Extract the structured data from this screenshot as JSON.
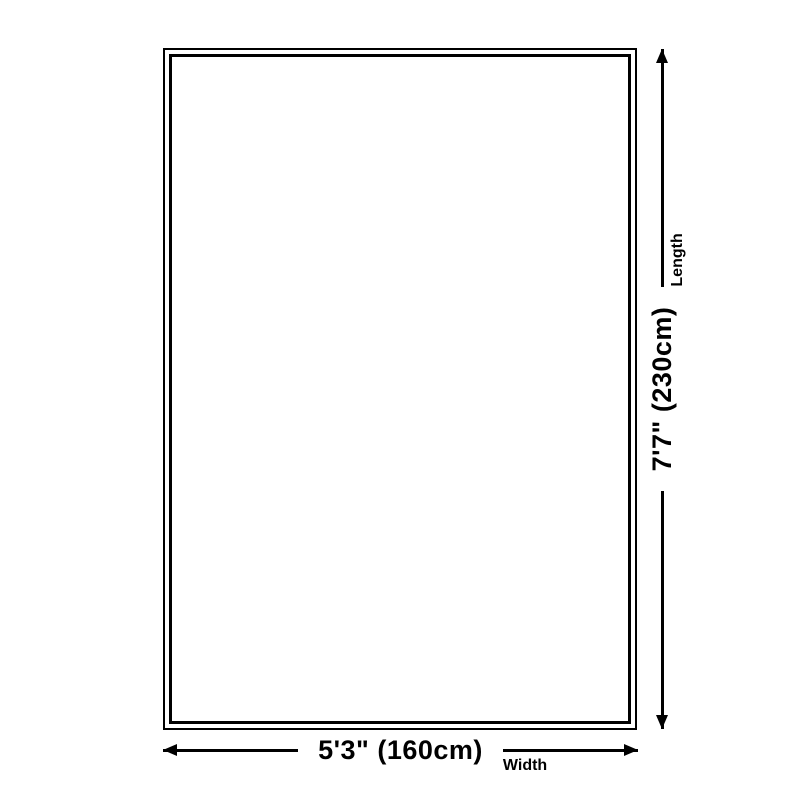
{
  "diagram": {
    "background_color": "#ffffff",
    "line_color": "#000000",
    "dimensions": {
      "width": {
        "value": "5'3\" (160cm)",
        "label": "Width"
      },
      "length": {
        "value": "7'7\" (230cm)",
        "label": "Length"
      }
    }
  }
}
